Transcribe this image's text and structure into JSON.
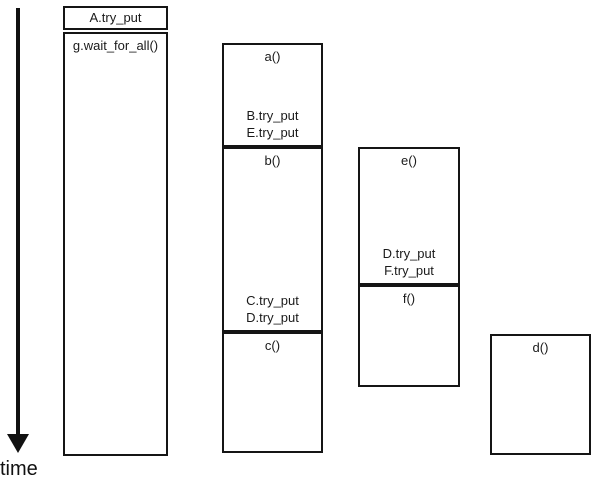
{
  "colors": {
    "background": "#ffffff",
    "ink": "#111111"
  },
  "time_axis": {
    "label": "time"
  },
  "columns": [
    {
      "boxes": [
        {
          "label": "A.try_put",
          "bottom_labels": []
        },
        {
          "label": "g.wait_for_all()",
          "bottom_labels": []
        }
      ]
    },
    {
      "boxes": [
        {
          "label": "a()",
          "bottom_labels": [
            "B.try_put",
            "E.try_put"
          ]
        },
        {
          "label": "b()",
          "bottom_labels": [
            "C.try_put",
            "D.try_put"
          ]
        },
        {
          "label": "c()",
          "bottom_labels": []
        }
      ]
    },
    {
      "boxes": [
        {
          "label": "e()",
          "bottom_labels": [
            "D.try_put",
            "F.try_put"
          ]
        },
        {
          "label": "f()",
          "bottom_labels": []
        }
      ]
    },
    {
      "boxes": [
        {
          "label": "d()",
          "bottom_labels": []
        }
      ]
    }
  ]
}
